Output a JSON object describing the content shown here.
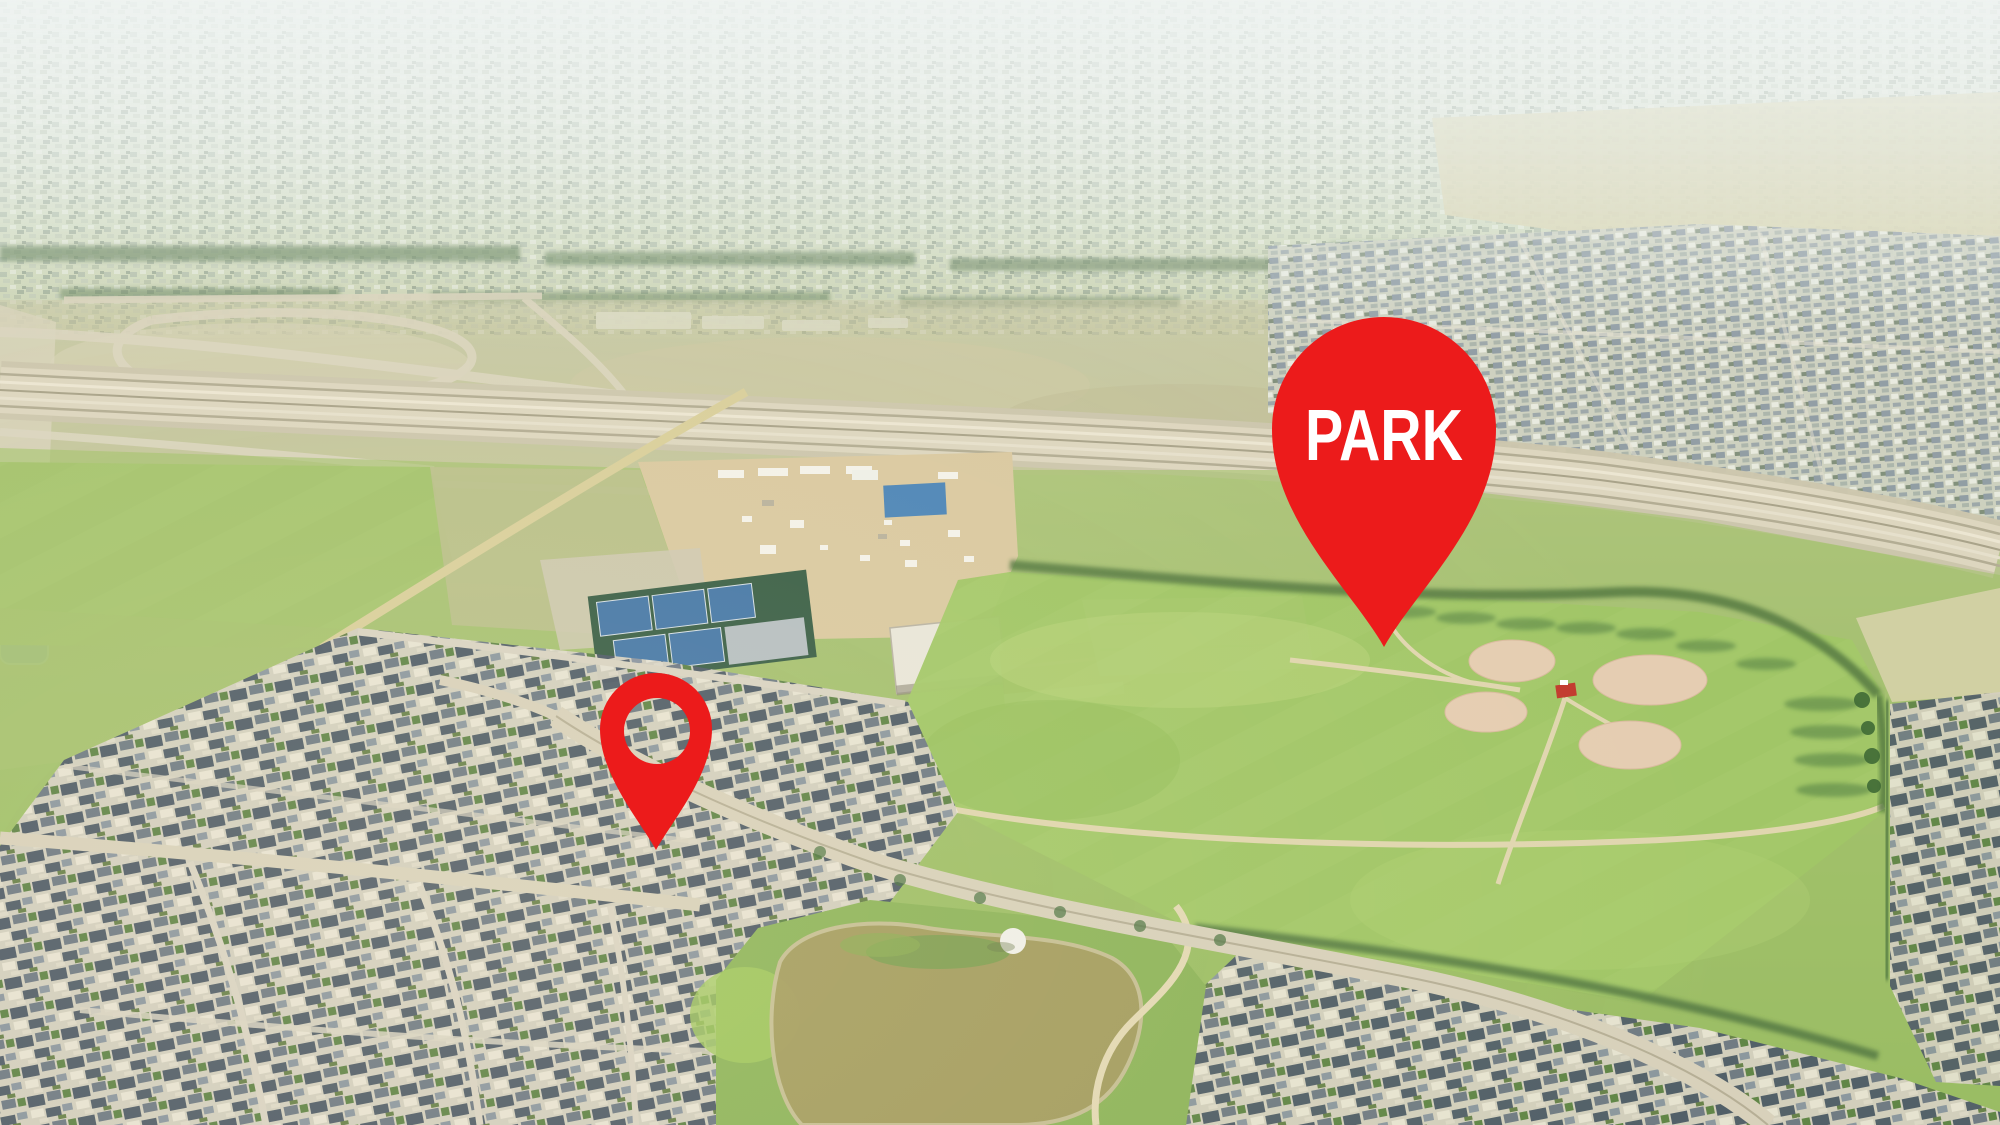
{
  "photo": {
    "kind": "aerial-drone-photo",
    "description": "Aerial view of a suburban neighborhood beside a community park with ball fields, tennis courts, a pond and a highway"
  },
  "markers": {
    "park": {
      "label": "PARK",
      "pin_color": "#ec1b1b",
      "label_color": "#ffffff"
    },
    "home": {
      "label": "",
      "pin_color": "#ec1b1b"
    }
  }
}
